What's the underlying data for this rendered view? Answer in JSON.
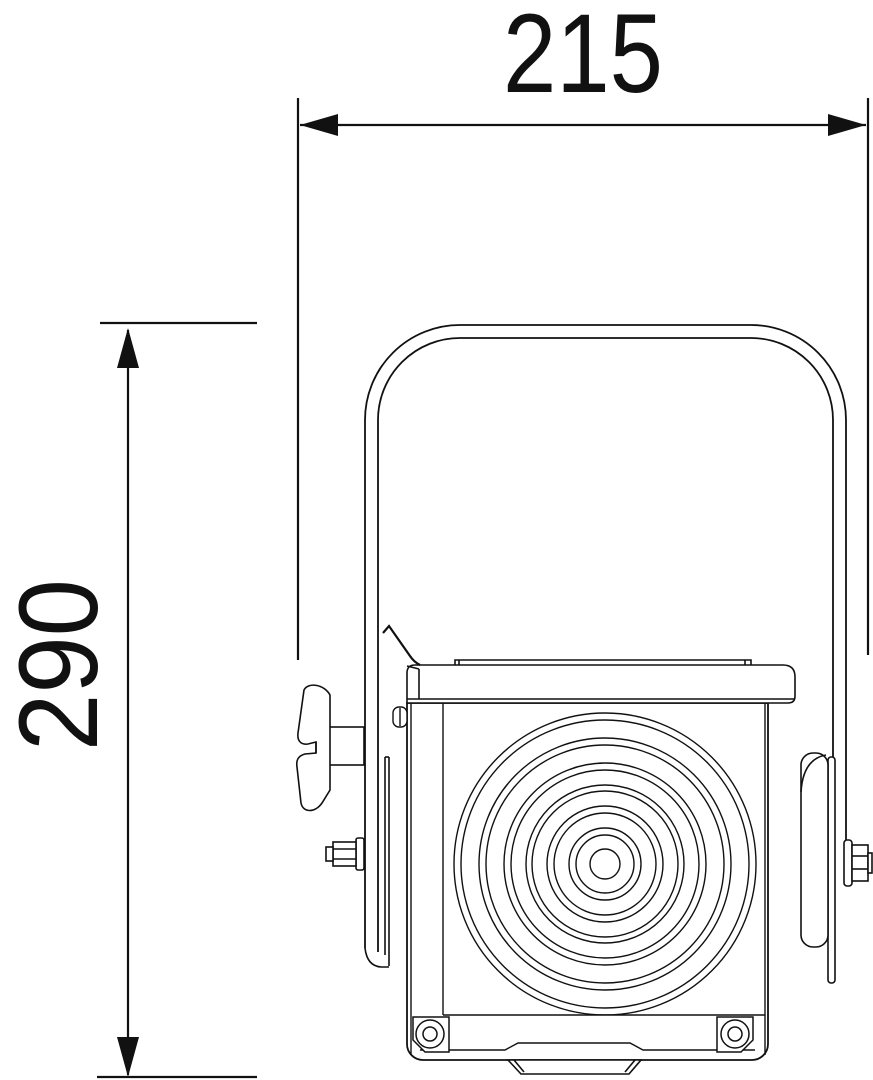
{
  "drawing": {
    "subject": "Fresnel spotlight front elevation with overall dimensions",
    "line_color": "#111111",
    "background_color": "#ffffff",
    "dimensions": {
      "width": {
        "label": "215"
      },
      "height": {
        "label": "290"
      }
    }
  }
}
